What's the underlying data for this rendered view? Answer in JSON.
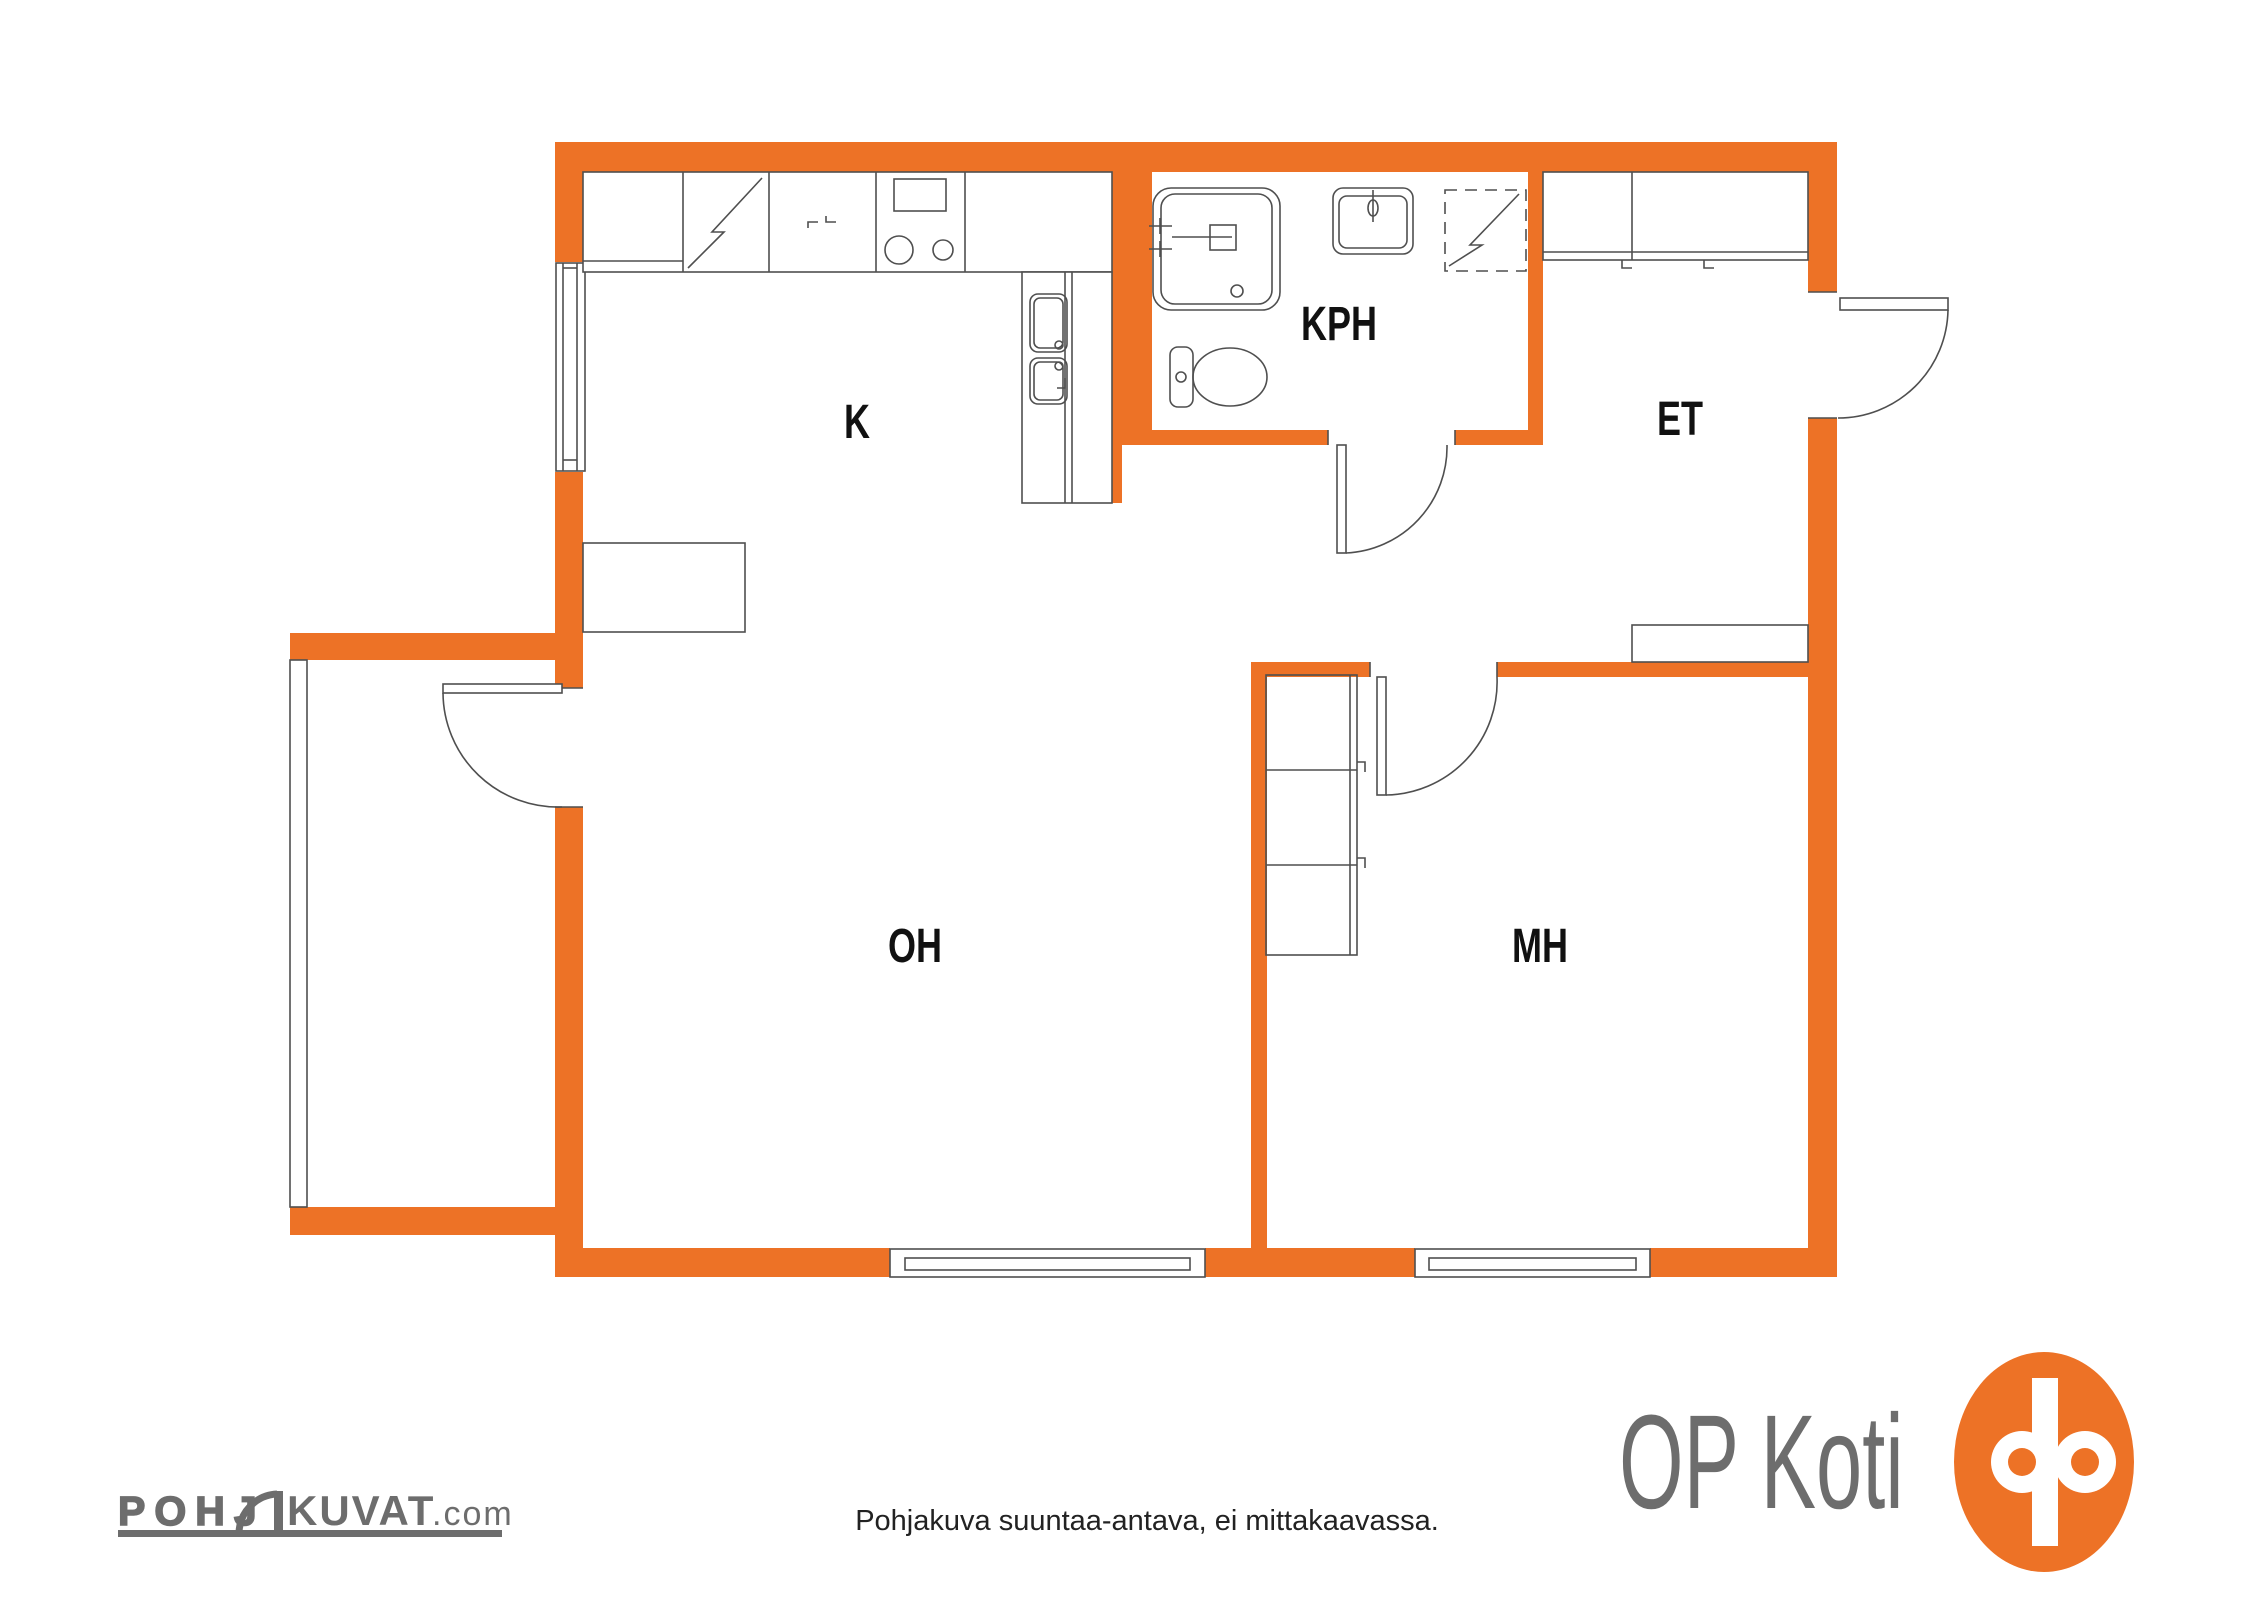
{
  "title": "Apartment floor plan",
  "colors": {
    "wall_orange": "#ED7226",
    "line_gray": "#4F4F4F",
    "logo_gray": "#6D6D6D",
    "label_black": "#111111"
  },
  "rooms": {
    "kitchen": {
      "label": "K"
    },
    "bathroom": {
      "label": "KPH"
    },
    "entry": {
      "label": "ET"
    },
    "living_room": {
      "label": "OH"
    },
    "bedroom": {
      "label": "MH"
    }
  },
  "branding": {
    "op_koti": {
      "text": "OP Koti"
    },
    "pohjakuvat": {
      "prefix": "POHJ",
      "main": "KUVAT",
      "tld": ".com"
    }
  },
  "footer": {
    "disclaimer": "Pohjakuva suuntaa-antava, ei mittakaavassa."
  }
}
